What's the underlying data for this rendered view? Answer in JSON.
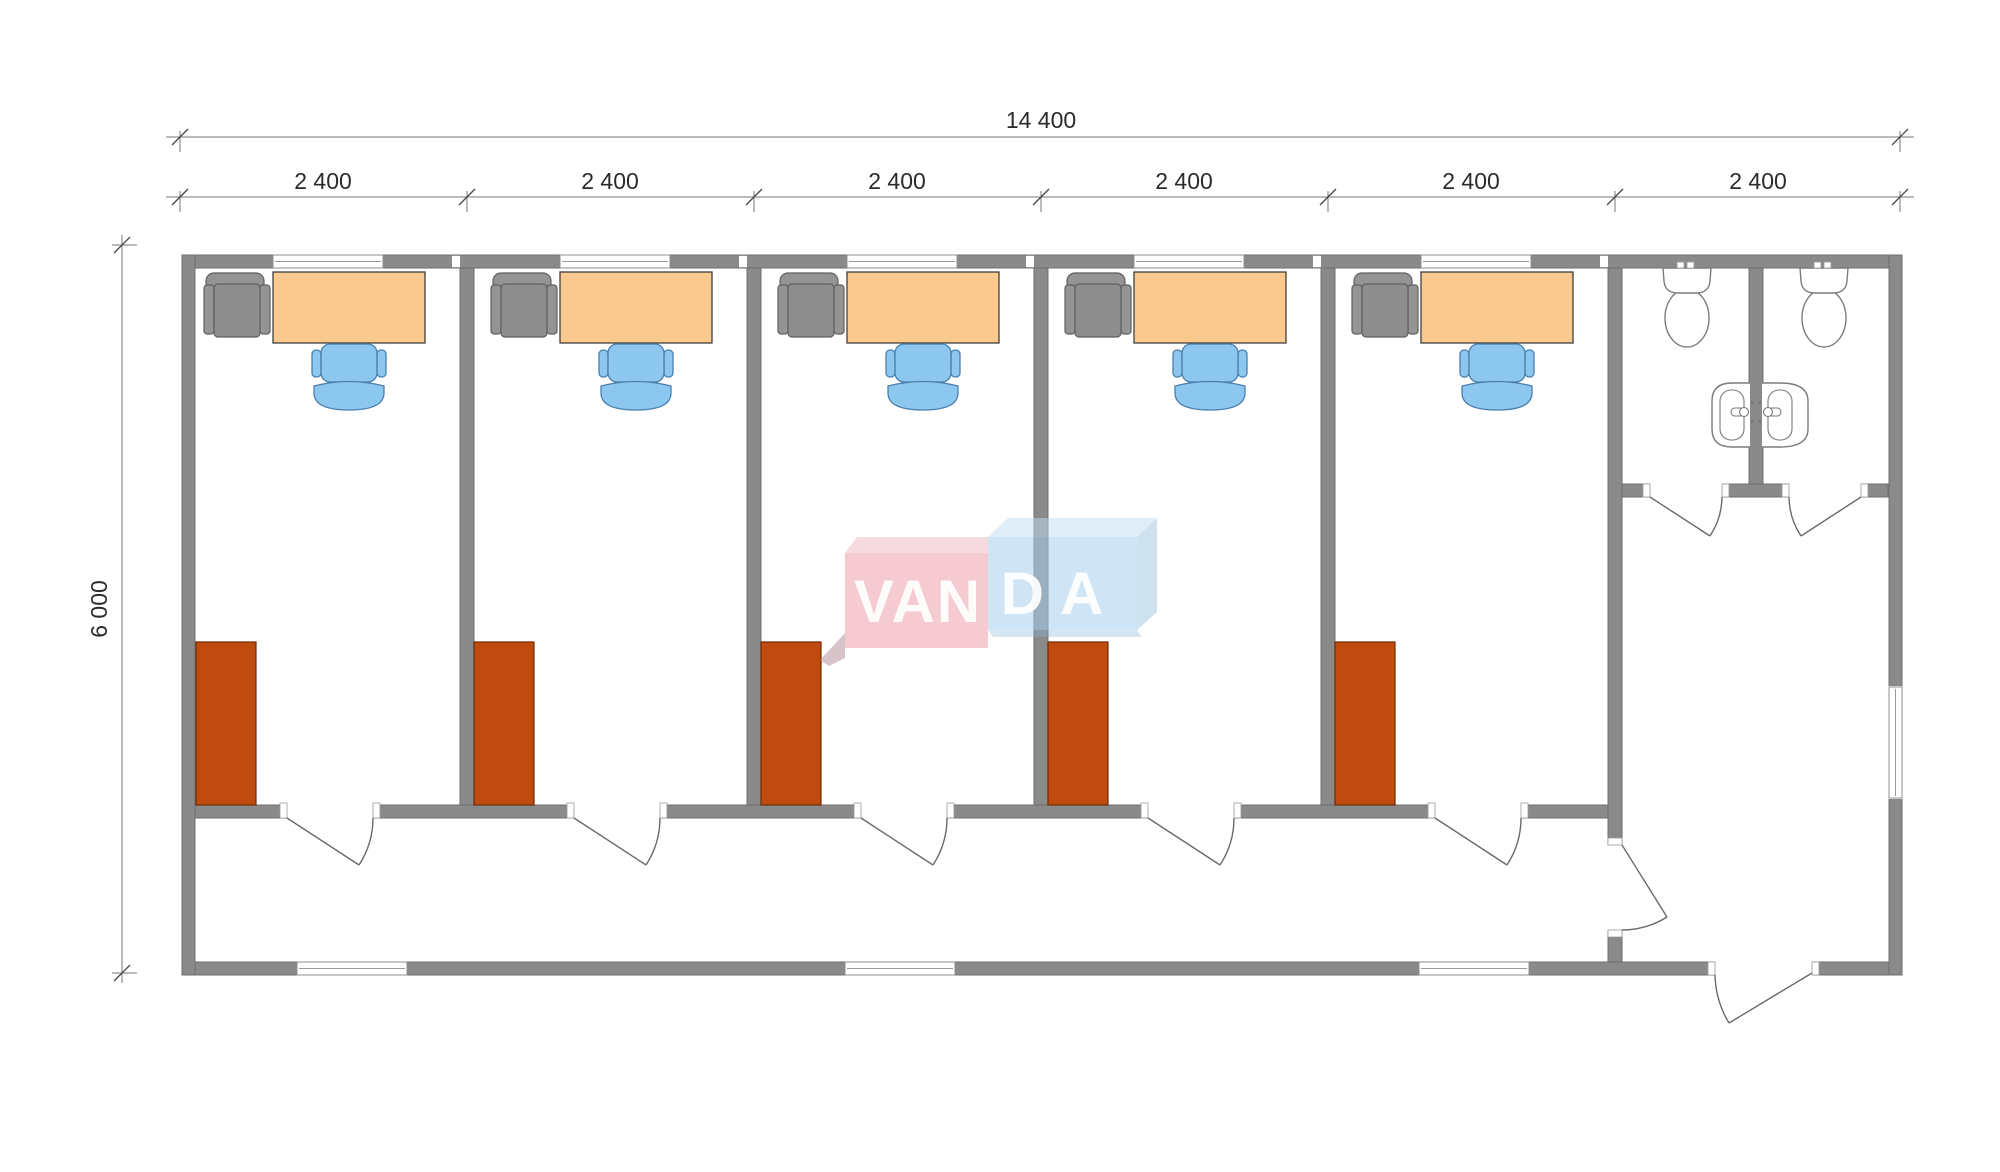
{
  "dimensions": {
    "total_width": "14 400",
    "segments": [
      "2 400",
      "2 400",
      "2 400",
      "2 400",
      "2 400",
      "2 400"
    ],
    "depth": "6 000"
  },
  "watermark": {
    "left_text": "VAN",
    "right_text": "DA"
  },
  "colors": {
    "wall": "#8a8a8a",
    "wall_edge": "#6f6f6f",
    "door": "#6a6a6a",
    "desk": "#f9c98d",
    "desk_edge": "#3f3f3f",
    "chair": "#8cc7f0",
    "chair_edge": "#4a7fae",
    "armchair": "#949494",
    "armchair_edge": "#5f5f5f",
    "wardrobe": "#c04b0e",
    "wardrobe_edge": "#6e2a06",
    "fixture_edge": "#7b7b7b",
    "dimension": "#2b2b2b",
    "dim_line": "#777777",
    "logo_pink": "#eb9aa6",
    "logo_pink_top": "#f0b6bf",
    "logo_blue": "#a8cfec",
    "logo_blue_top": "#c3dcef",
    "logo_blue_side": "#9cc3e0",
    "logo_text": "#ffffff"
  }
}
